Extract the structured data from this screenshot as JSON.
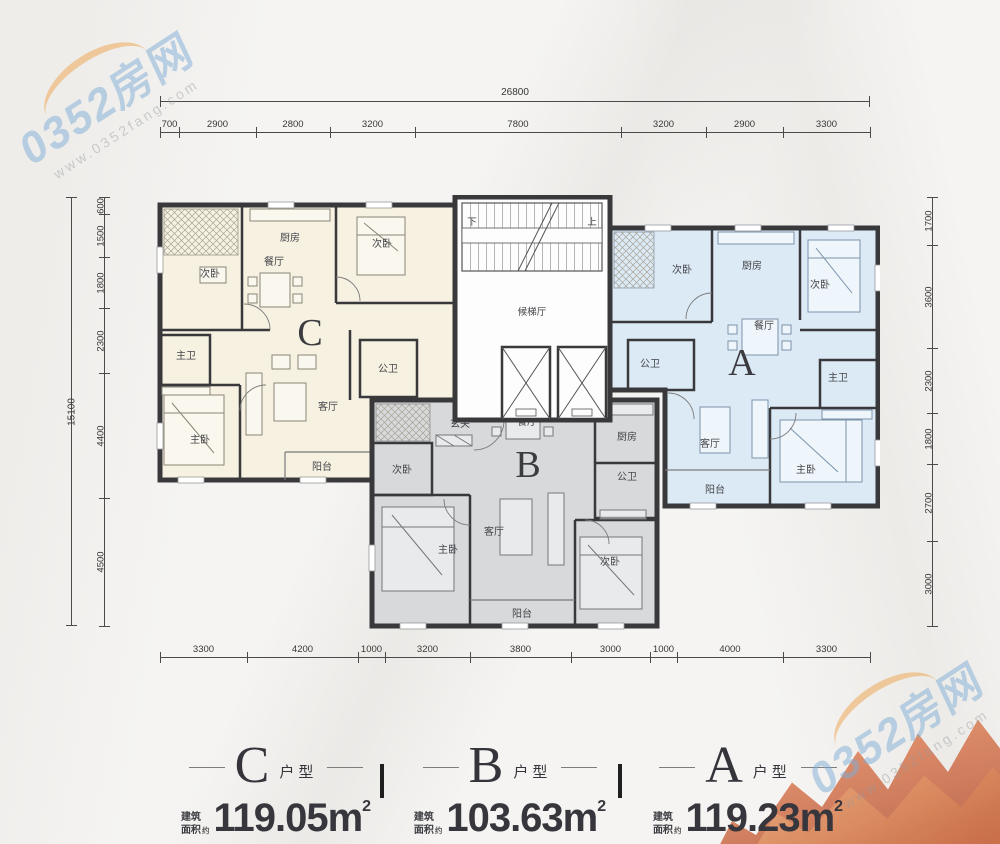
{
  "watermark": {
    "brand": "0352房网",
    "site": "www.0352fang.com"
  },
  "dims": {
    "top": {
      "total": "26800",
      "segments": [
        "700",
        "2900",
        "2800",
        "3200",
        "7800",
        "3200",
        "2900",
        "3300"
      ]
    },
    "left": {
      "total": "15100",
      "segments": [
        "600",
        "1500",
        "1800",
        "2300",
        "4400",
        "4500"
      ]
    },
    "right": {
      "segments": [
        "1700",
        "3600",
        "2300",
        "1800",
        "2700",
        "3000"
      ]
    },
    "bottom": {
      "segments": [
        "3300",
        "4200",
        "1000",
        "3200",
        "3800",
        "3000",
        "1000",
        "4000",
        "3300"
      ]
    }
  },
  "plan": {
    "core": {
      "down": "下",
      "up": "上",
      "hall": "候梯厅"
    },
    "units": {
      "C": {
        "letter": "C",
        "color": "#f6f1e1",
        "rooms": {
          "bed2a": "次卧",
          "kitchen": "厨房",
          "dining": "餐厅",
          "bed2b": "次卧",
          "master_bath": "主卫",
          "public_bath": "公卫",
          "master_bed": "主卧",
          "living": "客厅",
          "balcony": "阳台"
        }
      },
      "B": {
        "letter": "B",
        "color": "#d7d9db",
        "rooms": {
          "entry": "玄关",
          "dining": "餐厅",
          "kitchen": "厨房",
          "public_bath": "公卫",
          "bed2a": "次卧",
          "master_bed": "主卧",
          "living": "客厅",
          "bed2b": "次卧",
          "balcony": "阳台"
        }
      },
      "A": {
        "letter": "A",
        "color": "#dceaf6",
        "rooms": {
          "bed2a": "次卧",
          "kitchen": "厨房",
          "bed2b": "次卧",
          "dining": "餐厅",
          "public_bath": "公卫",
          "master_bath": "主卫",
          "living": "客厅",
          "master_bed": "主卧",
          "balcony": "阳台"
        }
      }
    }
  },
  "legend": {
    "sep": "|",
    "items": [
      {
        "letter": "C",
        "suffix": "户型",
        "area_line1": "建筑",
        "area_line2": "面积",
        "approx": "约",
        "area": "119.05m",
        "sup": "2",
        "r1": "三室",
        "r2": "两厅",
        "r3": "两卫"
      },
      {
        "letter": "B",
        "suffix": "户型",
        "area_line1": "建筑",
        "area_line2": "面积",
        "approx": "约",
        "area": "103.63m",
        "sup": "2",
        "r1": "三室",
        "r2": "两厅",
        "r3": "一卫"
      },
      {
        "letter": "A",
        "suffix": "户型",
        "area_line1": "建筑",
        "area_line2": "面积",
        "approx": "约",
        "area": "119.23m",
        "sup": "2",
        "r1": "三室",
        "r2": "两厅",
        "r3": "两卫"
      }
    ]
  }
}
